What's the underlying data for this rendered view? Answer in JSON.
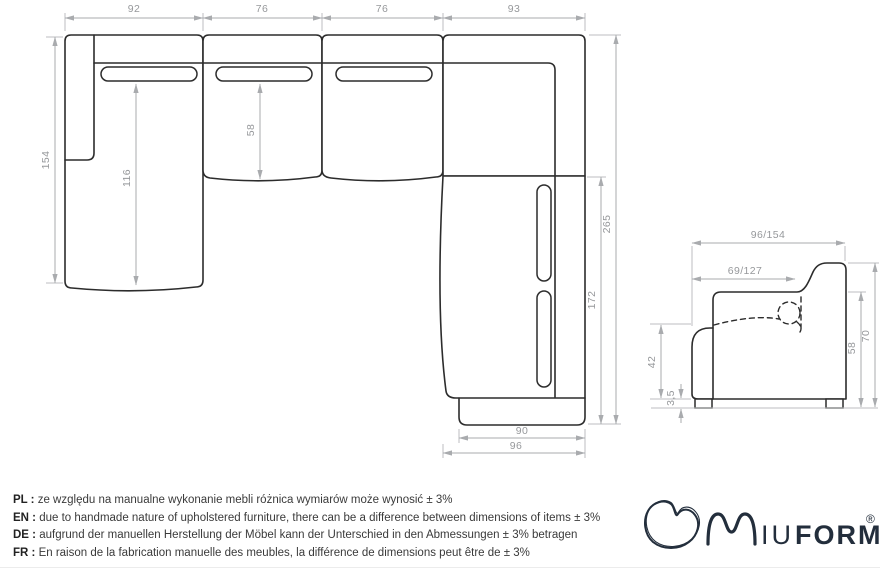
{
  "plan": {
    "seg1": "92",
    "seg2": "76",
    "seg3": "76",
    "seg4": "93",
    "chaise_length": "154",
    "chaise_seat": "116",
    "seat_depth": "58",
    "right_total": "265",
    "right_seat": "172",
    "ottoman_width": "90",
    "bottom_width": "96"
  },
  "profile": {
    "total_depth": "96/154",
    "seat_depth": "69/127",
    "seat_height": "42",
    "leg_height": "3,5",
    "back_height": "58",
    "total_height": "70"
  },
  "disclaimer": {
    "pl_label": "PL :",
    "pl_text": "ze względu na manualne wykonanie mebli różnica wymiarów może wynosić ± 3%",
    "en_label": "EN :",
    "en_text": "due to handmade nature of upholstered furniture, there can be a difference between dimensions of items ± 3%",
    "de_label": "DE :",
    "de_text": "aufgrund der manuellen Herstellung der Möbel kann der Unterschied in den Abmessungen ± 3% betragen",
    "fr_label": "FR :",
    "fr_text": "En raison de la fabrication manuelle des meubles, la différence de dimensions peut être de ± 3%"
  },
  "logo": {
    "iu": "IU",
    "form": "FORM",
    "reg": "®"
  },
  "colors": {
    "outline": "#2c2c2c",
    "dimension": "#a9abae",
    "dim_text": "#96989b",
    "note_text": "#3a3a3a",
    "logo": "#232e3c"
  }
}
